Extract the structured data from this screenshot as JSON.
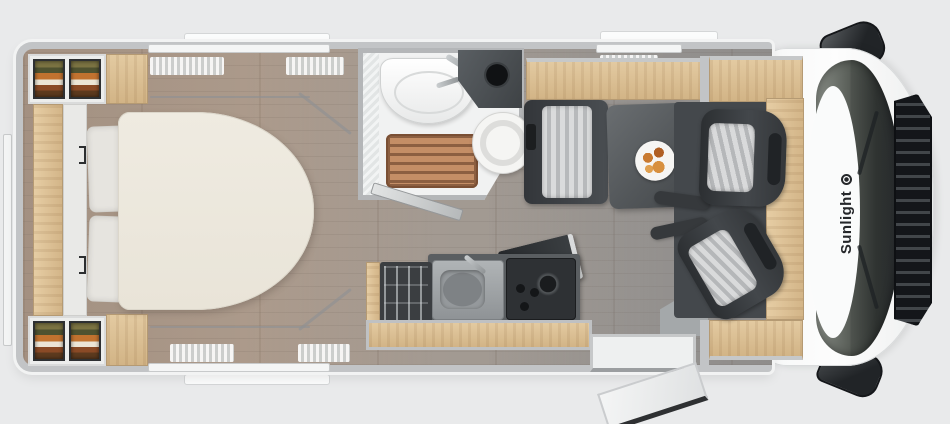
{
  "brand": {
    "name": "Sunlight"
  },
  "diagram": {
    "type": "motorhome-floor-plan",
    "view": "top-down",
    "orientation": "cab-front-right, bedroom-rear-left",
    "zones": [
      {
        "id": "bedroom",
        "items": [
          "island-bed",
          "pillow",
          "pillow",
          "headboard-cabinet",
          "wardrobe-shelves-top",
          "wardrobe-shelves-bottom",
          "overhead-cabinet-top",
          "overhead-cabinet-bottom",
          "side-shelf",
          "rear-window"
        ]
      },
      {
        "id": "bathroom",
        "items": [
          "washbasin",
          "vanity-counter",
          "toilet",
          "shower-grate",
          "open-door"
        ]
      },
      {
        "id": "dinette",
        "items": [
          "bench-seat",
          "dining-table",
          "plate-of-food",
          "overhead-locker",
          "tv-panel"
        ]
      },
      {
        "id": "kitchen",
        "items": [
          "refrigerator",
          "sink",
          "cooktop",
          "worktop-edge"
        ]
      },
      {
        "id": "entrance",
        "items": [
          "entry-door-open",
          "entry-step"
        ]
      },
      {
        "id": "cab",
        "items": [
          "driver-seat",
          "passenger-seat",
          "armrest",
          "armrest",
          "dashboard-wood-trim",
          "windshield",
          "front-grille",
          "wiper",
          "wiper",
          "side-mirror-top",
          "side-mirror-bottom"
        ]
      }
    ],
    "windows": [
      "top-wall-window-left",
      "top-wall-window-right",
      "bottom-wall-window",
      "pleated-curtains"
    ],
    "palette": {
      "background": "#e9eaeb",
      "wall_gray": "#c2c4c6",
      "floor_wood": "#a79a8e",
      "furniture_wood": "#ddc49c",
      "bed_cream": "#ece8dd",
      "dark_furniture": "#3c3f42",
      "seat_stripe_light": "#d7d8d9",
      "shower_wood": "#bd8a63",
      "clothes_olive": "#7b7342",
      "clothes_orange": "#c1722f",
      "food_orange": "#d8903f",
      "glass_dark": "#2f3331",
      "brand_text": "#25272a"
    }
  }
}
